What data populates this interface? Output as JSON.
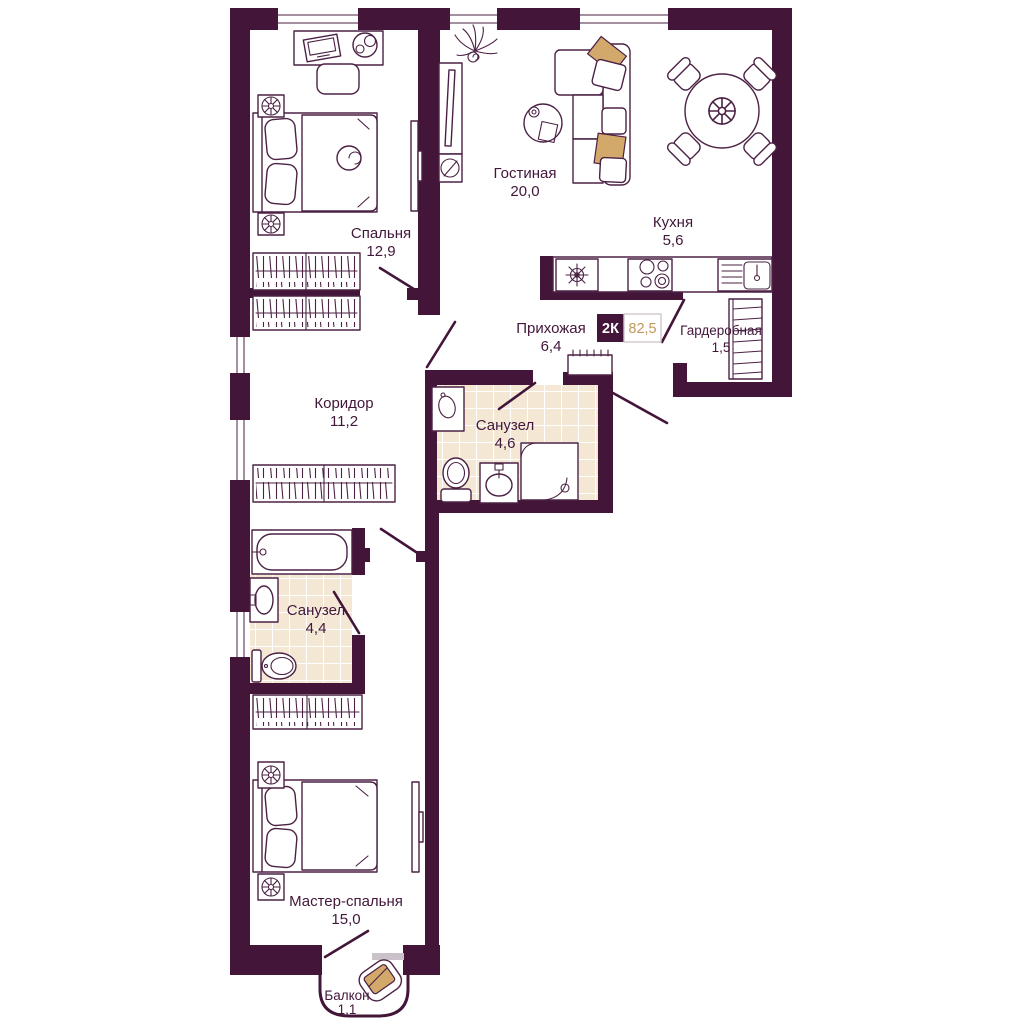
{
  "plan": {
    "badge": {
      "type_label": "2К",
      "total_area": "82,5"
    },
    "rooms": [
      {
        "name": "Спальня",
        "area": "12,9"
      },
      {
        "name": "Гостиная",
        "area": "20,0"
      },
      {
        "name": "Кухня",
        "area": "5,6"
      },
      {
        "name": "Прихожая",
        "area": "6,4"
      },
      {
        "name": "Гардеробная",
        "area": "1,5"
      },
      {
        "name": "Коридор",
        "area": "11,2"
      },
      {
        "name": "Санузел",
        "area": "4,6"
      },
      {
        "name": "Санузел",
        "area": "4,4"
      },
      {
        "name": "Мастер-спальня",
        "area": "15,0"
      },
      {
        "name": "Балкон",
        "area": "1,1"
      }
    ],
    "colors": {
      "wall": "#421539",
      "furniture_line": "#4b2144",
      "text": "#42173a",
      "tile_floor": "#f4e8d5",
      "accent_tan": "#d2a96b",
      "area_value_gold": "#c0985c",
      "window_sill_gray": "#c9c2c9",
      "badge_border": "#cfc8cc",
      "background": "#ffffff"
    }
  }
}
